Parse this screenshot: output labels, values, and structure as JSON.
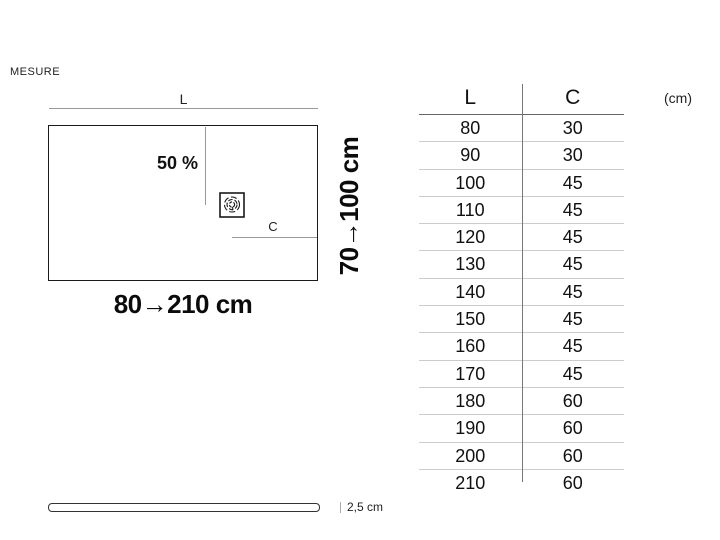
{
  "header": {
    "section_label": "MESURE"
  },
  "diagram": {
    "top_dimension_label": "L",
    "slope_label": "50 %",
    "drain_dimension_label": "C",
    "length_range_label": "80→210 cm",
    "width_range_label": "70→100 cm",
    "drain_icon": "shower-drain-icon"
  },
  "size_table": {
    "unit_label": "(cm)",
    "columns": [
      "L",
      "C"
    ],
    "rows": [
      [
        "80",
        "30"
      ],
      [
        "90",
        "30"
      ],
      [
        "100",
        "45"
      ],
      [
        "110",
        "45"
      ],
      [
        "120",
        "45"
      ],
      [
        "130",
        "45"
      ],
      [
        "140",
        "45"
      ],
      [
        "150",
        "45"
      ],
      [
        "160",
        "45"
      ],
      [
        "170",
        "45"
      ],
      [
        "180",
        "60"
      ],
      [
        "190",
        "60"
      ],
      [
        "200",
        "60"
      ],
      [
        "210",
        "60"
      ]
    ]
  },
  "side_view": {
    "thickness_label": "2,5 cm"
  },
  "chart_data": {
    "type": "table",
    "columns": [
      "L",
      "C"
    ],
    "unit": "cm",
    "rows": [
      [
        80,
        30
      ],
      [
        90,
        30
      ],
      [
        100,
        45
      ],
      [
        110,
        45
      ],
      [
        120,
        45
      ],
      [
        130,
        45
      ],
      [
        140,
        45
      ],
      [
        150,
        45
      ],
      [
        160,
        45
      ],
      [
        170,
        45
      ],
      [
        180,
        60
      ],
      [
        190,
        60
      ],
      [
        200,
        60
      ],
      [
        210,
        60
      ]
    ],
    "length_range": [
      80,
      210
    ],
    "width_range": [
      70,
      100
    ],
    "thickness_cm": 2.5,
    "slope_percent_label": "50 %"
  },
  "colors": {
    "text": "#111111",
    "dimension_line_gray": "#999999",
    "table_divider": "#777777",
    "row_separator": "#cccccc",
    "background": "#ffffff"
  }
}
